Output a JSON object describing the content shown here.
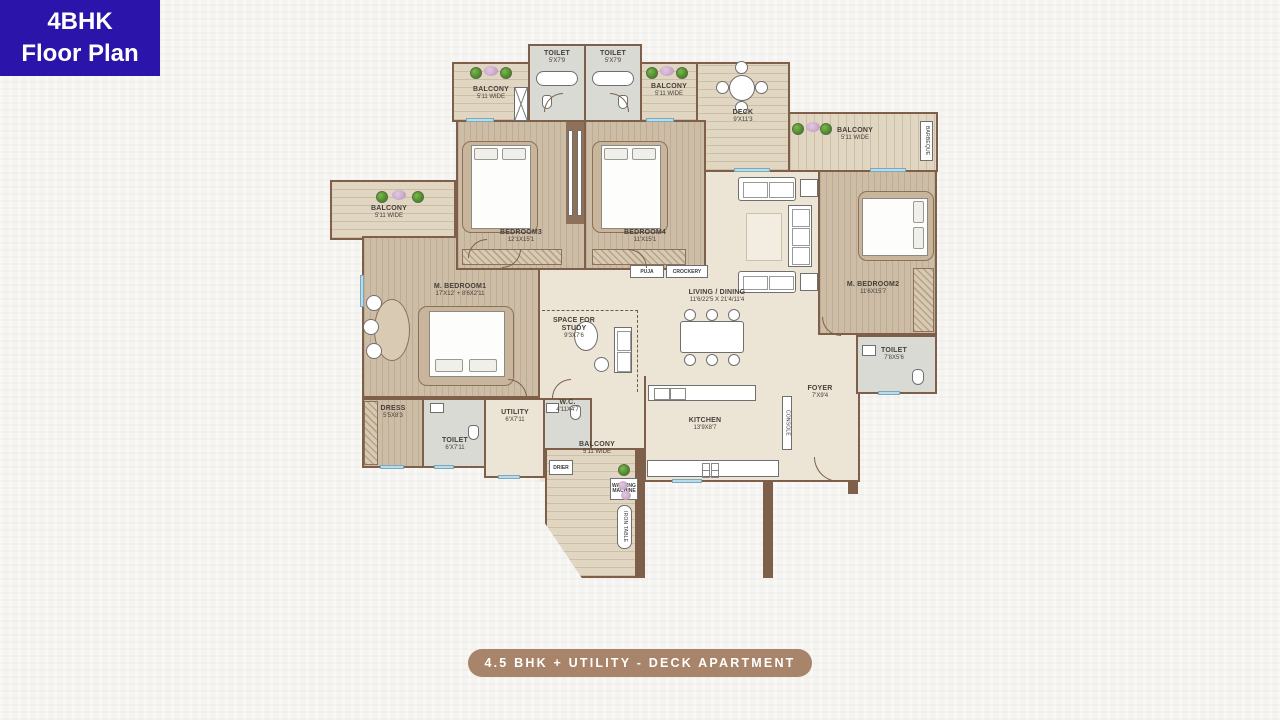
{
  "badge": {
    "line1": "4BHK",
    "line2": "Floor Plan",
    "bg_color": "#2a14a9"
  },
  "caption": {
    "text": "4.5 BHK + UTILITY - DECK APARTMENT",
    "bg_color": "#a8846a"
  },
  "colors": {
    "wall": "#7e604a",
    "floor_wood": "#cdbca6",
    "floor_beige": "#ece4d5",
    "floor_plank": "#e1d6c1",
    "floor_tile": "#d9dad4",
    "window_glass": "#b9dcea",
    "plant_green": "#4e8f2c",
    "flower_pink": "#ba92ba"
  },
  "rooms": {
    "toilet_top_left": {
      "name": "TOILET",
      "dims": "5'X7'9"
    },
    "toilet_top_right": {
      "name": "TOILET",
      "dims": "5'X7'9"
    },
    "balcony_top_left": {
      "name": "BALCONY",
      "dims": "5'11 WIDE"
    },
    "balcony_top_right": {
      "name": "BALCONY",
      "dims": "5'11 WIDE"
    },
    "deck": {
      "name": "DECK",
      "dims": "9'X11'3"
    },
    "balcony_right": {
      "name": "BALCONY",
      "dims": "5'11 WIDE"
    },
    "bedroom3": {
      "name": "BEDROOM3",
      "dims": "12'1X15'1"
    },
    "bedroom4": {
      "name": "BEDROOM4",
      "dims": "11'X15'1"
    },
    "m_bedroom2": {
      "name": "M. BEDROOM2",
      "dims": "11'6X15'7"
    },
    "toilet_mbed2": {
      "name": "TOILET",
      "dims": "7'8X5'6"
    },
    "living_dining": {
      "name": "LIVING / DINING",
      "dims": "11'6/22'5 X 21'4/11'4"
    },
    "balcony_left": {
      "name": "BALCONY",
      "dims": "5'11 WIDE"
    },
    "m_bedroom1": {
      "name": "M. BEDROOM1",
      "dims": "17'X12' + 8'6X2'11"
    },
    "space_for_study": {
      "name": "SPACE FOR STUDY",
      "dims": "9'3X7'6"
    },
    "dress": {
      "name": "DRESS",
      "dims": "5'5X8'3"
    },
    "toilet_mbed1": {
      "name": "TOILET",
      "dims": "6'X7'11"
    },
    "utility": {
      "name": "UTILITY",
      "dims": "6'X7'11"
    },
    "wc": {
      "name": "W.C.",
      "dims": "4'11X4'7"
    },
    "balcony_bottom": {
      "name": "BALCONY",
      "dims": "5'11 WIDE"
    },
    "kitchen": {
      "name": "KITCHEN",
      "dims": "13'9X8'7"
    },
    "foyer": {
      "name": "FOYER",
      "dims": "7'X9'4"
    }
  },
  "fixtures": {
    "puja": "PUJA",
    "crockery": "CROCKERY",
    "console": "CONSOLE",
    "drier": "DRIER",
    "washing_machine": "WASHING MACHINE",
    "iron_table": "IRON TABLE",
    "barbeque": "BARBEQUE"
  }
}
